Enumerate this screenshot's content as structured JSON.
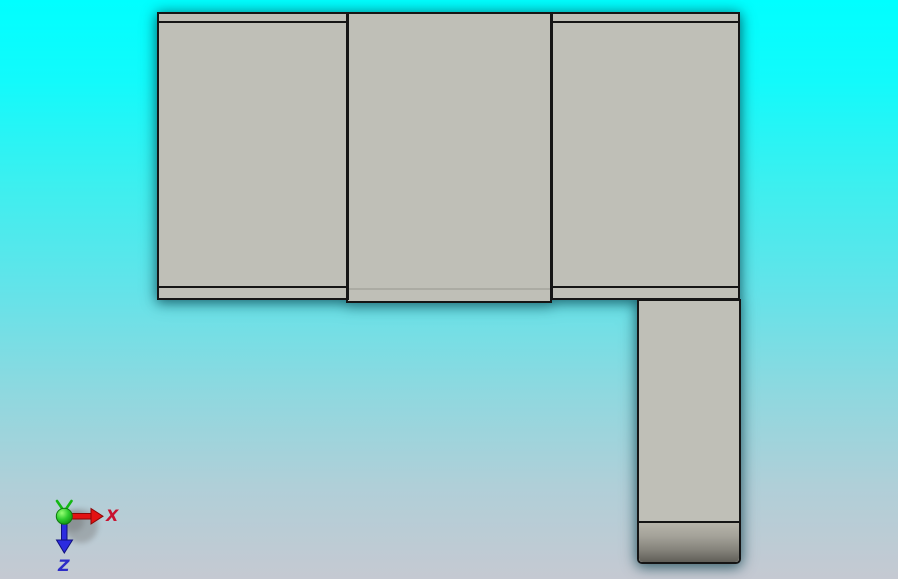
{
  "viewport": {
    "kind": "3d-cad-viewport",
    "background_top_color": "#00ffff",
    "background_mid_color": "#63e3e9",
    "background_bottom_color": "#c5c9d2"
  },
  "model": {
    "face_color": "#bfbfb7",
    "edge_color": "#151515",
    "lower_shaded_face_color": "#605f58"
  },
  "triad": {
    "x_axis": {
      "label": "X",
      "color": "#c81230"
    },
    "z_axis": {
      "label": "Z",
      "color": "#2c2cc8"
    },
    "y_axis": {
      "label": "",
      "color": "#1eb41e"
    }
  }
}
